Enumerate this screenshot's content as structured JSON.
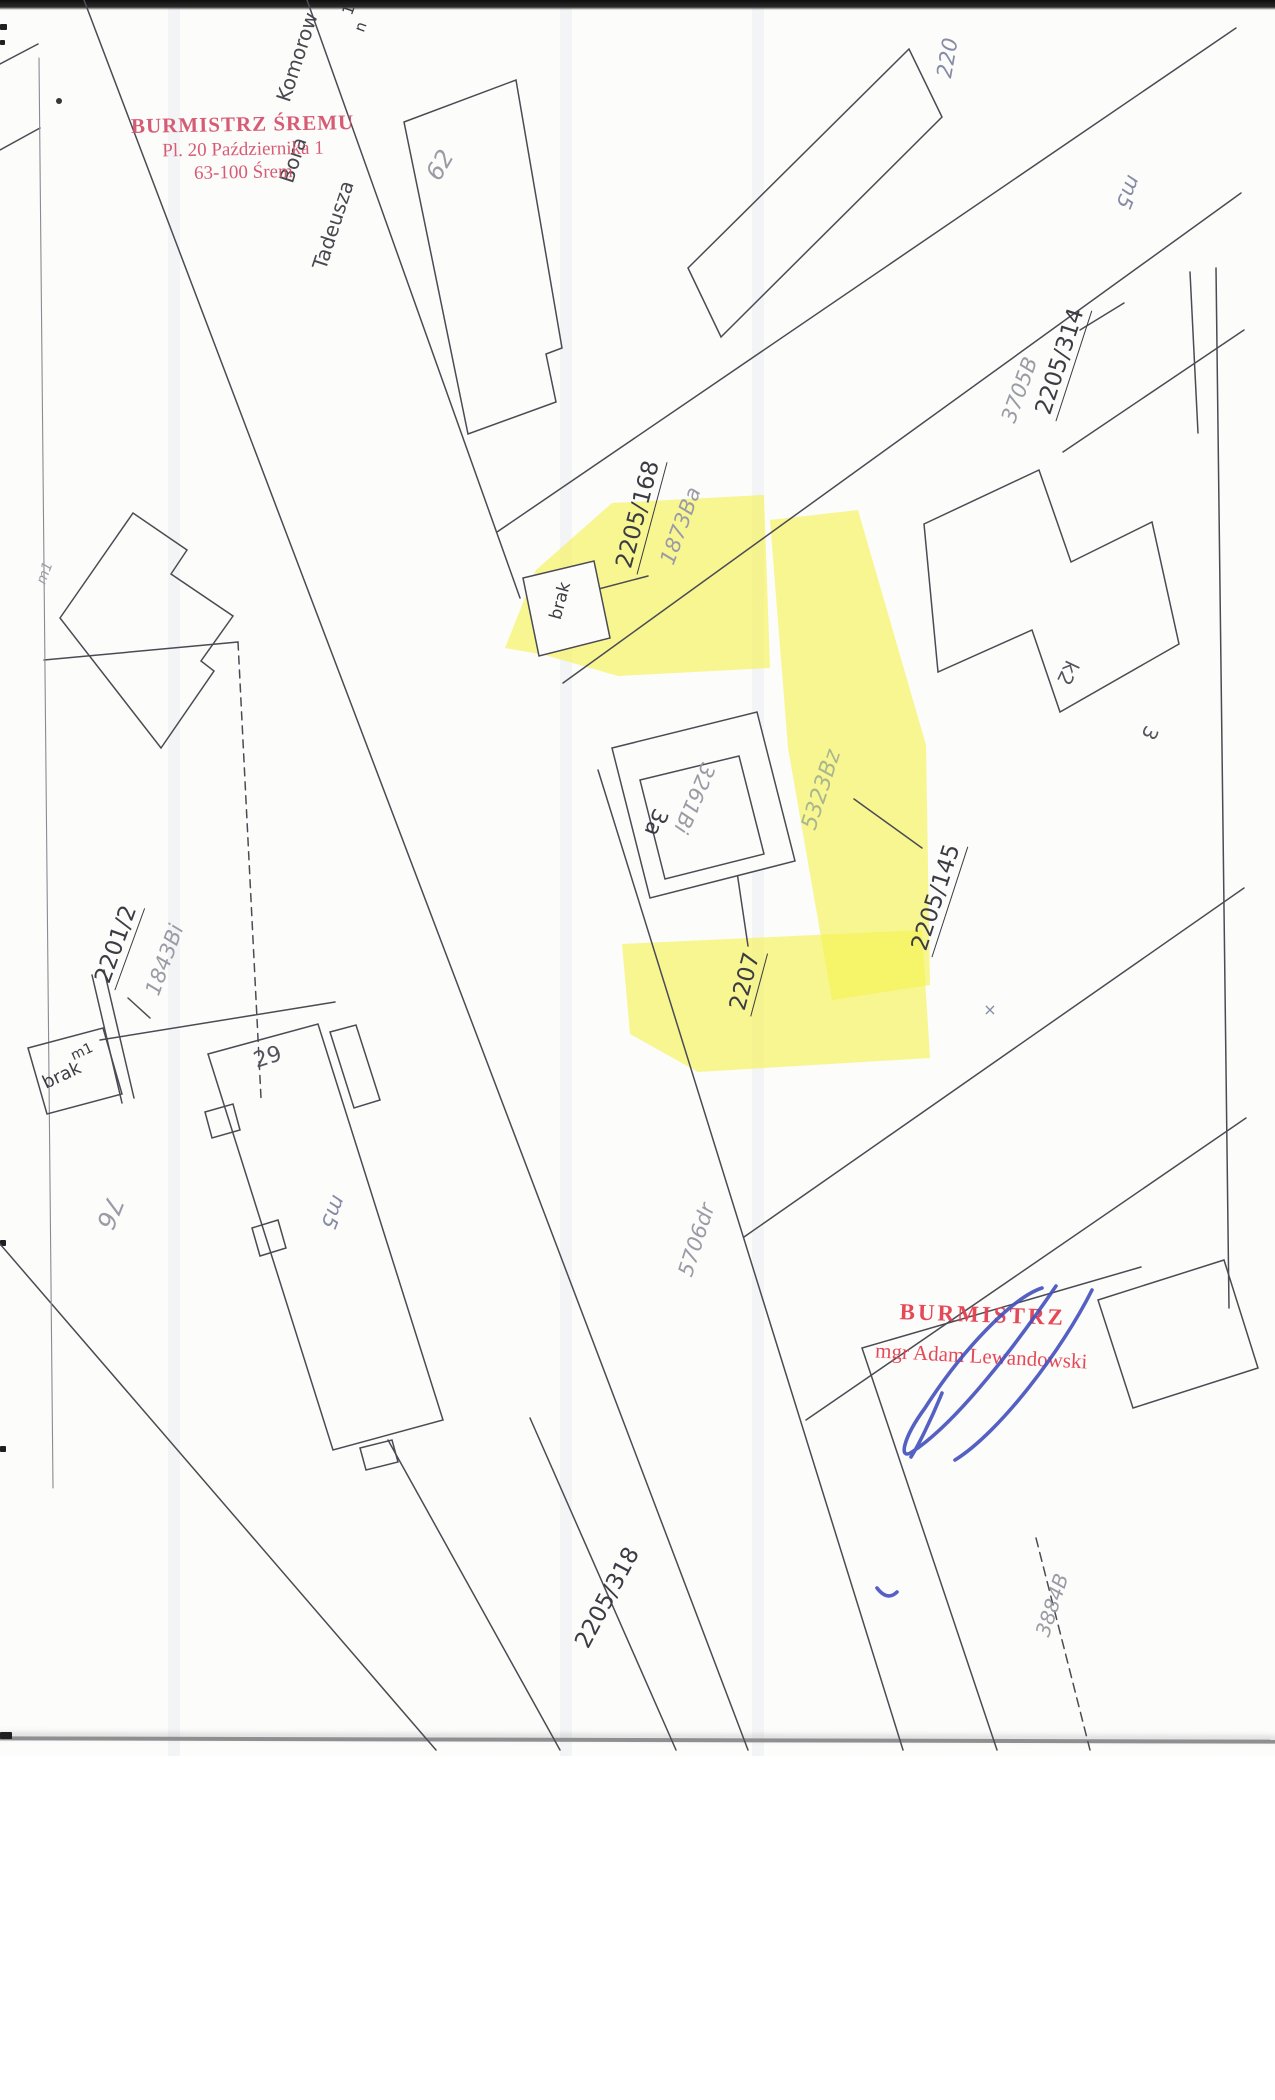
{
  "colors": {
    "paper": "#fcfcfb",
    "line": "#4b4b54",
    "label_black": "#3b3b44",
    "label_gray": "#9b9ba6",
    "label_green": "#a9b68e",
    "highlight": "#f6f24f",
    "stamp_red_top": "#d4506b",
    "stamp_red_bottom": "#e4404f",
    "signature_blue": "#4450bd"
  },
  "stamps": {
    "top": {
      "line1": "BURMISTRZ ŚREMU",
      "line2": "Pl. 20 Października 1",
      "line3": "63-100 Śrem"
    },
    "bottom": {
      "line1": "BURMISTRZ",
      "line2": "mgr Adam Lewandowski"
    }
  },
  "map": {
    "labels": [
      {
        "name": "edge-label-1",
        "text": "1",
        "x": 349,
        "y": 10,
        "rot": -70,
        "style": "black",
        "size": 15
      },
      {
        "name": "edge-label-n",
        "text": "n",
        "x": 361,
        "y": 27,
        "rot": -70,
        "style": "black",
        "size": 15
      },
      {
        "name": "street-komorow",
        "text": "Komorow",
        "x": 297,
        "y": 57,
        "rot": -72,
        "style": "street",
        "size": 20
      },
      {
        "name": "street-bora",
        "text": "Bora",
        "x": 293,
        "y": 160,
        "rot": -72,
        "style": "street",
        "size": 20
      },
      {
        "name": "street-tadeusza",
        "text": "Tadeusza",
        "x": 333,
        "y": 225,
        "rot": -72,
        "style": "street",
        "size": 20
      },
      {
        "name": "building-62",
        "text": "62",
        "x": 440,
        "y": 165,
        "rot": -60,
        "style": "gray",
        "size": 24
      },
      {
        "name": "building-m5-ne",
        "text": "m5",
        "x": 1128,
        "y": 192,
        "rot": 112,
        "style": "gray2",
        "size": 21
      },
      {
        "name": "parcel-220",
        "text": "220",
        "x": 948,
        "y": 58,
        "rot": -80,
        "style": "gray2",
        "size": 21
      },
      {
        "name": "parcel-3705B",
        "text": "3705B",
        "x": 1020,
        "y": 390,
        "rot": -70,
        "style": "gray",
        "size": 21
      },
      {
        "name": "parcel-2205-314",
        "text": "2205/314",
        "x": 1062,
        "y": 362,
        "rot": -72,
        "style": "black-u",
        "size": 23
      },
      {
        "name": "parcel-2205-168",
        "text": "2205/168",
        "x": 640,
        "y": 515,
        "rot": -75,
        "style": "black-u",
        "size": 23
      },
      {
        "name": "parcel-1873Ba",
        "text": "1873Ba",
        "x": 681,
        "y": 526,
        "rot": -70,
        "style": "gray",
        "size": 21
      },
      {
        "name": "building-brak-n",
        "text": "brak",
        "x": 561,
        "y": 601,
        "rot": -75,
        "style": "black",
        "size": 17
      },
      {
        "name": "building-3a",
        "text": "3a",
        "x": 655,
        "y": 822,
        "rot": 113,
        "style": "black",
        "size": 22
      },
      {
        "name": "building-3261Bi",
        "text": "3261Bi",
        "x": 694,
        "y": 798,
        "rot": 113,
        "style": "gray",
        "size": 21
      },
      {
        "name": "parcel-5323Bz",
        "text": "5323Bz",
        "x": 822,
        "y": 790,
        "rot": -72,
        "style": "green",
        "size": 22
      },
      {
        "name": "parcel-2205-145",
        "text": "2205/145",
        "x": 938,
        "y": 898,
        "rot": -72,
        "style": "black-u",
        "size": 23
      },
      {
        "name": "parcel-2207",
        "text": "2207",
        "x": 747,
        "y": 982,
        "rot": -75,
        "style": "black-u",
        "size": 23
      },
      {
        "name": "building-k2",
        "text": "k2",
        "x": 1068,
        "y": 673,
        "rot": 115,
        "style": "black2",
        "size": 20
      },
      {
        "name": "building-3",
        "text": "3",
        "x": 1150,
        "y": 733,
        "rot": 115,
        "style": "black2",
        "size": 20
      },
      {
        "name": "cross-mark",
        "text": "×",
        "x": 990,
        "y": 1010,
        "rot": 0,
        "style": "gray2",
        "size": 16
      },
      {
        "name": "parcel-2201-2",
        "text": "2201/2",
        "x": 118,
        "y": 945,
        "rot": -70,
        "style": "black-u",
        "size": 23
      },
      {
        "name": "parcel-1843Bi",
        "text": "1843Bi",
        "x": 165,
        "y": 960,
        "rot": -70,
        "style": "gray",
        "size": 21
      },
      {
        "name": "building-m1-sw",
        "text": "m1",
        "x": 82,
        "y": 1052,
        "rot": -25,
        "style": "black",
        "size": 14
      },
      {
        "name": "building-brak-sw",
        "text": "brak",
        "x": 62,
        "y": 1076,
        "rot": -25,
        "style": "black",
        "size": 18
      },
      {
        "name": "parcel-76",
        "text": "76",
        "x": 110,
        "y": 1213,
        "rot": 112,
        "style": "gray",
        "size": 25
      },
      {
        "name": "building-29",
        "text": "29",
        "x": 268,
        "y": 1058,
        "rot": -18,
        "style": "black2",
        "size": 22
      },
      {
        "name": "building-m5-w",
        "text": "m5",
        "x": 333,
        "y": 1212,
        "rot": 112,
        "style": "gray2",
        "size": 21
      },
      {
        "name": "parcel-5706dr",
        "text": "5706dr",
        "x": 697,
        "y": 1240,
        "rot": -72,
        "style": "gray",
        "size": 21
      },
      {
        "name": "parcel-2205-318",
        "text": "2205/318",
        "x": 608,
        "y": 1598,
        "rot": -62,
        "style": "black",
        "size": 23
      },
      {
        "name": "parcel-3884B",
        "text": "3884B",
        "x": 1052,
        "y": 1605,
        "rot": -72,
        "style": "gray",
        "size": 20
      },
      {
        "name": "building-m1-nw",
        "text": "m1",
        "x": 45,
        "y": 573,
        "rot": -70,
        "style": "gray",
        "size": 14
      }
    ]
  }
}
